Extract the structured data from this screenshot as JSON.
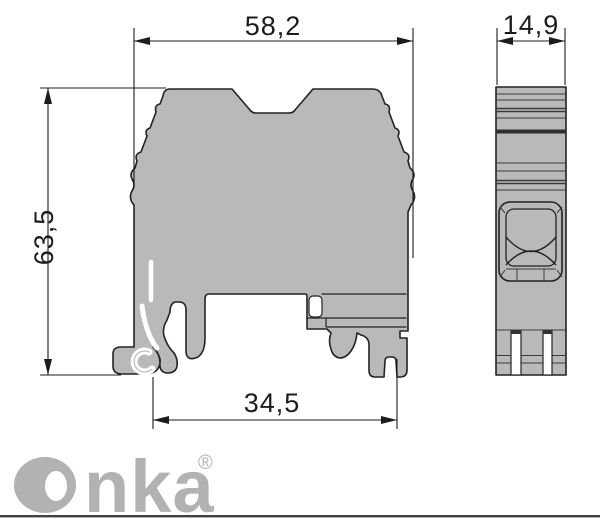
{
  "drawing": {
    "type": "terminal-block-dimension-drawing",
    "views": {
      "front_view": "terminal block front profile with DIN-rail feet",
      "side_view": "terminal block side profile with clamp opening"
    }
  },
  "dimensions": {
    "front_width_mm": "58,2",
    "front_height_mm": "63,5",
    "side_width_mm": "14,9",
    "rail_width_mm": "34,5"
  },
  "logo": {
    "wordmark": "Onka",
    "wordmark_tail": "nka",
    "registered": "®"
  },
  "colors": {
    "background": "#ffffff",
    "body_fill": "#b9b9b9",
    "outline": "#222222",
    "dimension_lines": "#1c1c1c",
    "logo_gray": "#b2b2b2",
    "footer_line": "#414141"
  }
}
